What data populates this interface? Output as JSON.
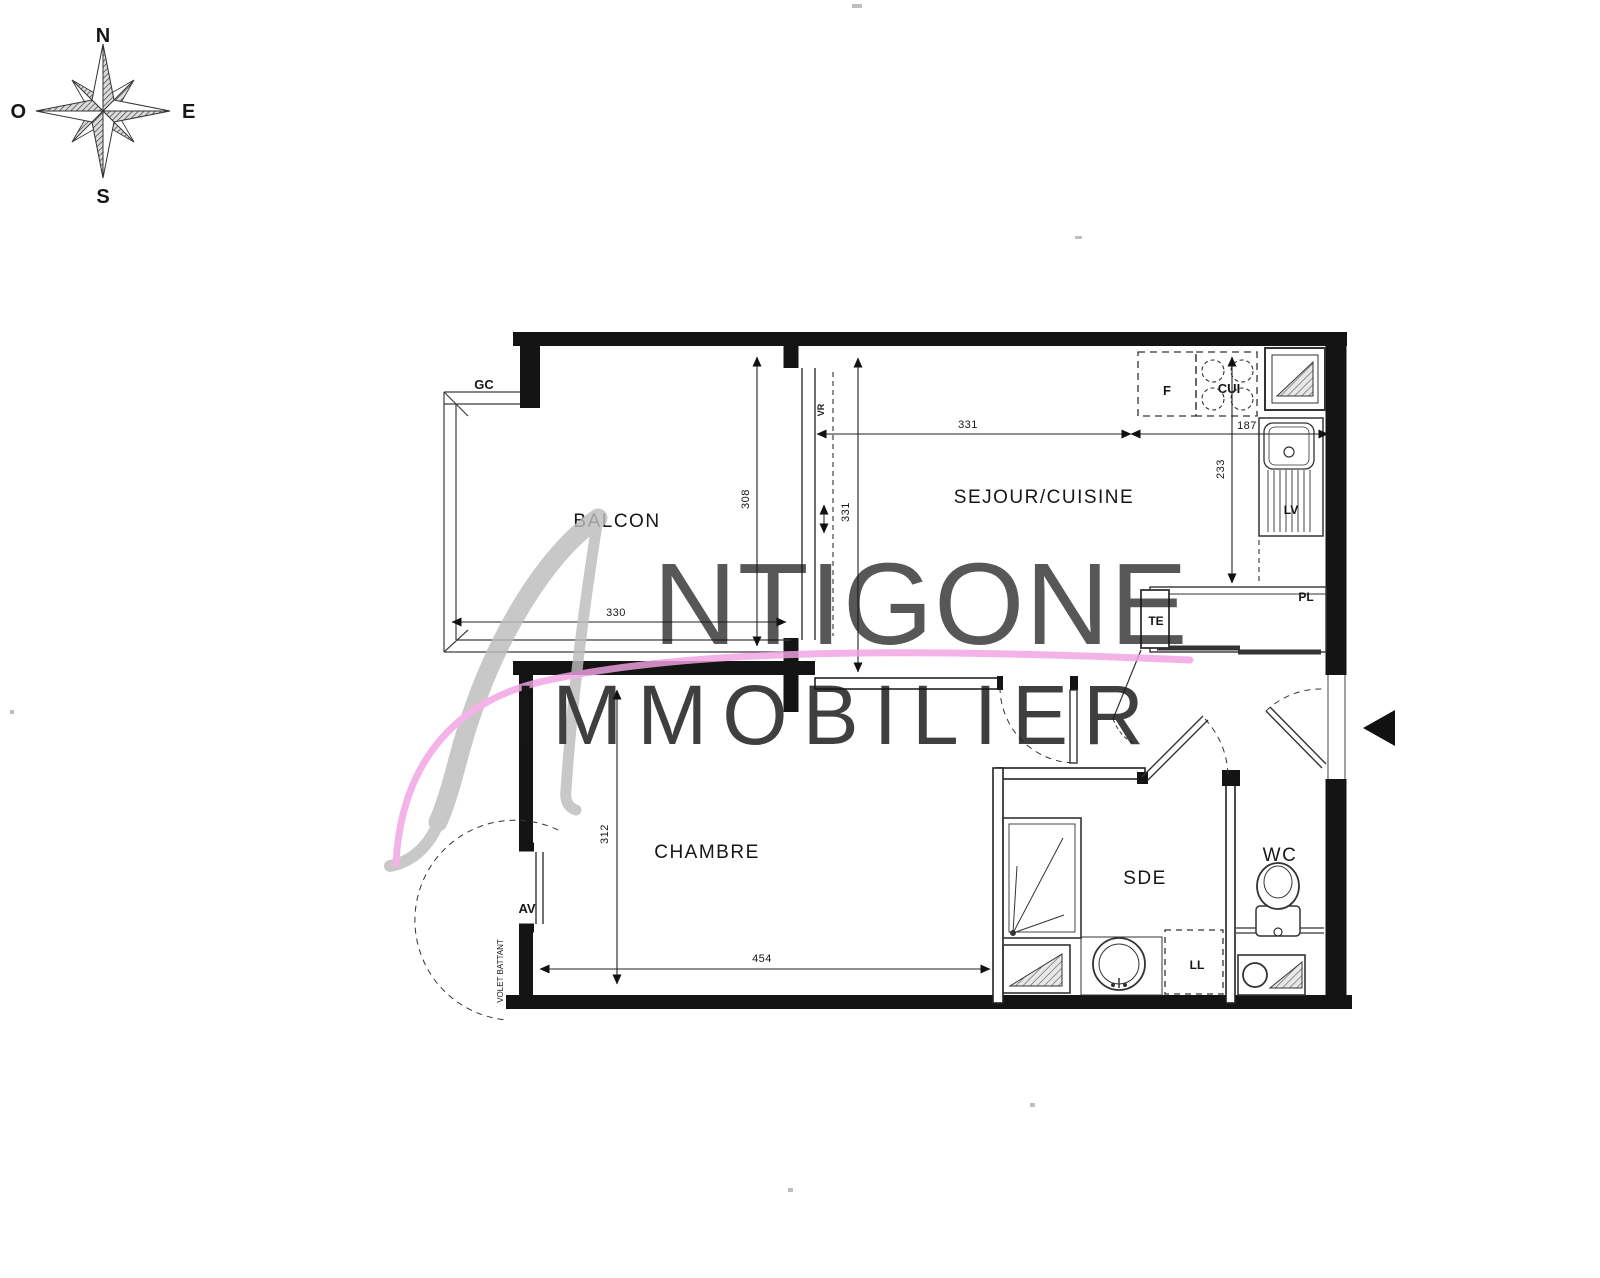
{
  "compass": {
    "north": "N",
    "east": "E",
    "south": "S",
    "west": "O"
  },
  "watermark": {
    "script_initial": "A",
    "brand": "NTIGONE",
    "tagline": "IMMOBILIER",
    "accent_color": "#f2a3e3",
    "gray_color": "#c7c7c7"
  },
  "rooms": {
    "balcony": "BALCON",
    "living_kitchen": "SEJOUR/CUISINE",
    "bedroom": "CHAMBRE",
    "shower_room": "SDE",
    "wc": "WC"
  },
  "dims": {
    "balcony_w": "330",
    "balcony_d": "308",
    "living_w": "331",
    "living_d": "331",
    "kitchen_w": "187",
    "kitchen_d": "233",
    "bedroom_w": "454",
    "bedroom_d": "312"
  },
  "tags": {
    "gc": "GC",
    "vr": "VR",
    "av": "AV",
    "volet": "VOLET BATTANT",
    "te": "TE",
    "pl": "PL",
    "lv": "LV",
    "ll": "LL",
    "f": "F",
    "cui": "CUI"
  }
}
